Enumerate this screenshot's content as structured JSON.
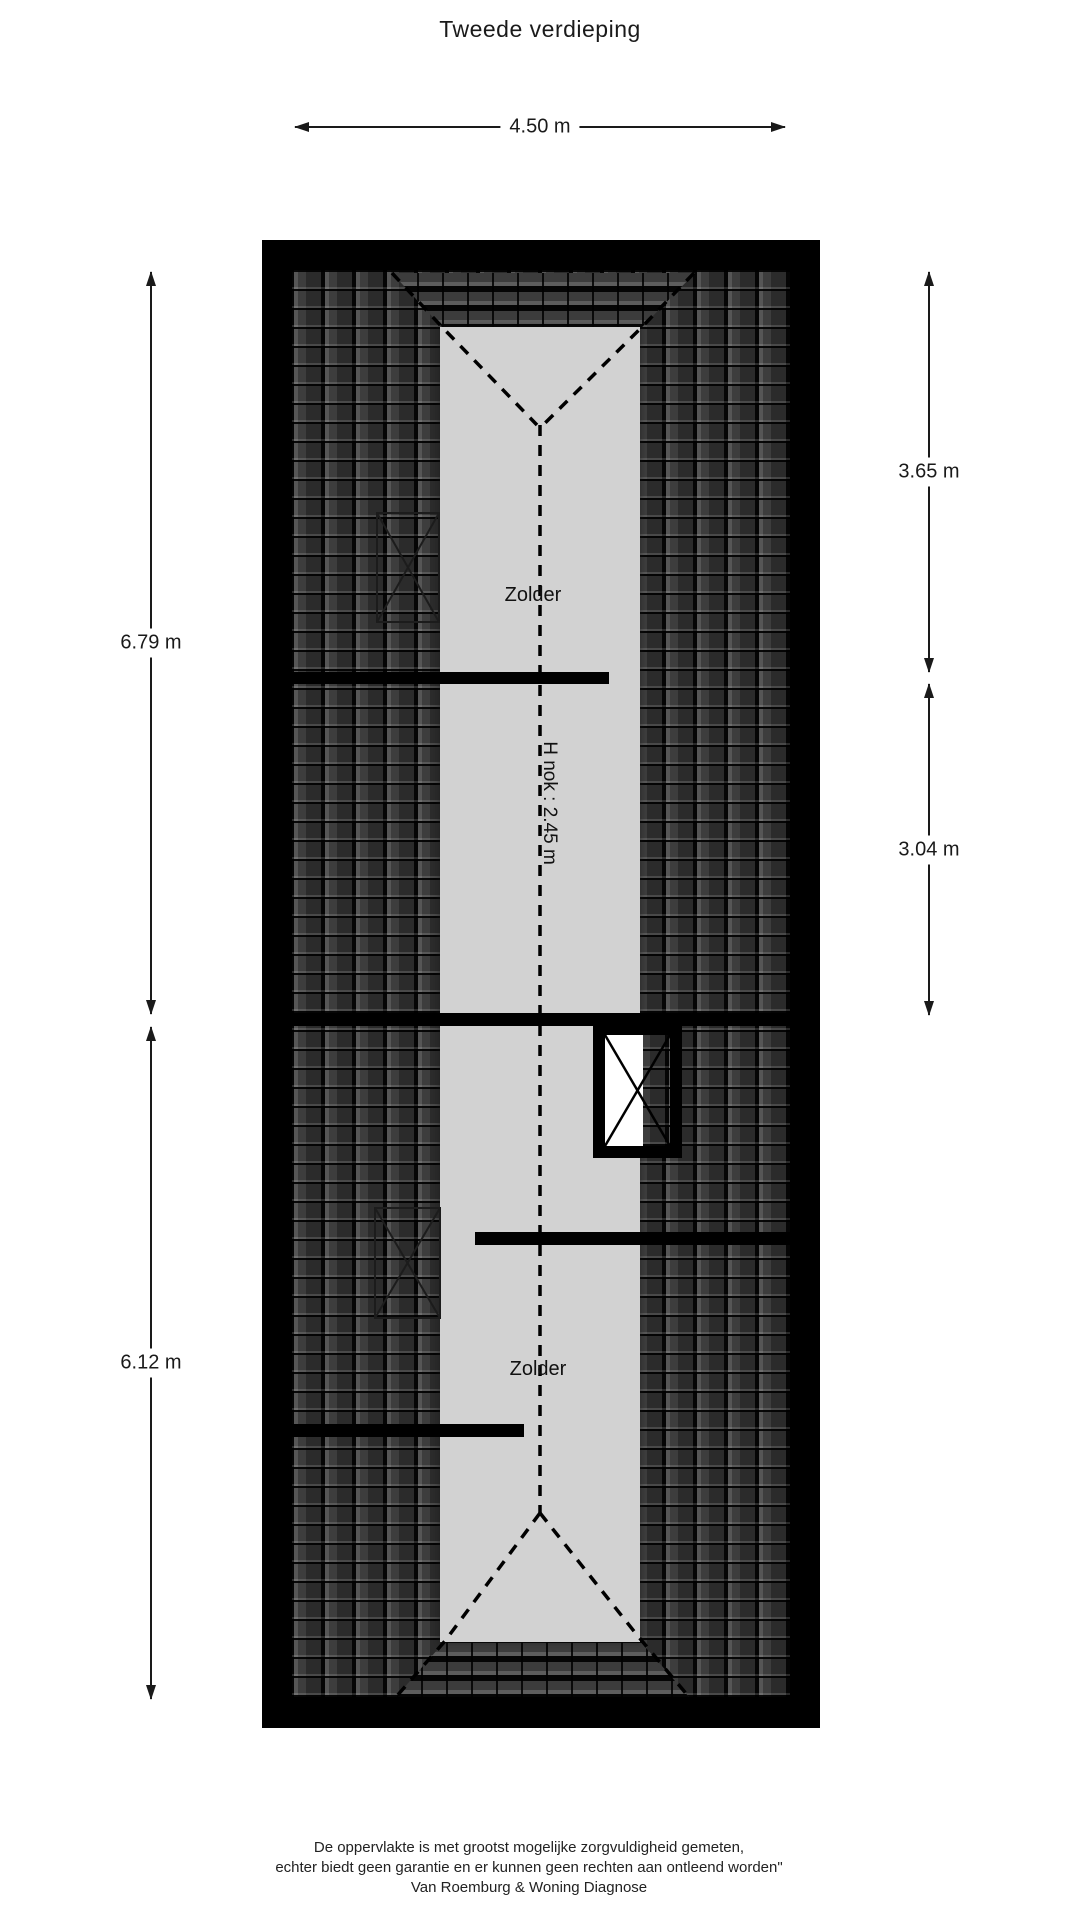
{
  "title": "Tweede verdieping",
  "dimensions": {
    "width_top": "4.50 m",
    "left_upper": "6.79 m",
    "left_lower": "6.12 m",
    "right_upper": "3.65 m",
    "right_lower": "3.04 m"
  },
  "rooms": {
    "upper": "Zolder",
    "lower": "Zolder"
  },
  "ridge": {
    "height_label": "H nok : 2.45 m"
  },
  "footer": {
    "line1": "De oppervlakte is met grootst mogelijke zorgvuldigheid gemeten,",
    "line2": "echter biedt geen garantie en er kunnen geen rechten aan ontleend worden\"",
    "line3": "Van Roemburg & Woning Diagnose"
  },
  "colors": {
    "wall": "#000000",
    "text": "#1a1a1a",
    "floor_gray": "#d2d2d2",
    "page_bg": "#ffffff",
    "roof_tile_dark": "#2e2e2e",
    "roof_tile_mid": "#3a3a3a"
  }
}
